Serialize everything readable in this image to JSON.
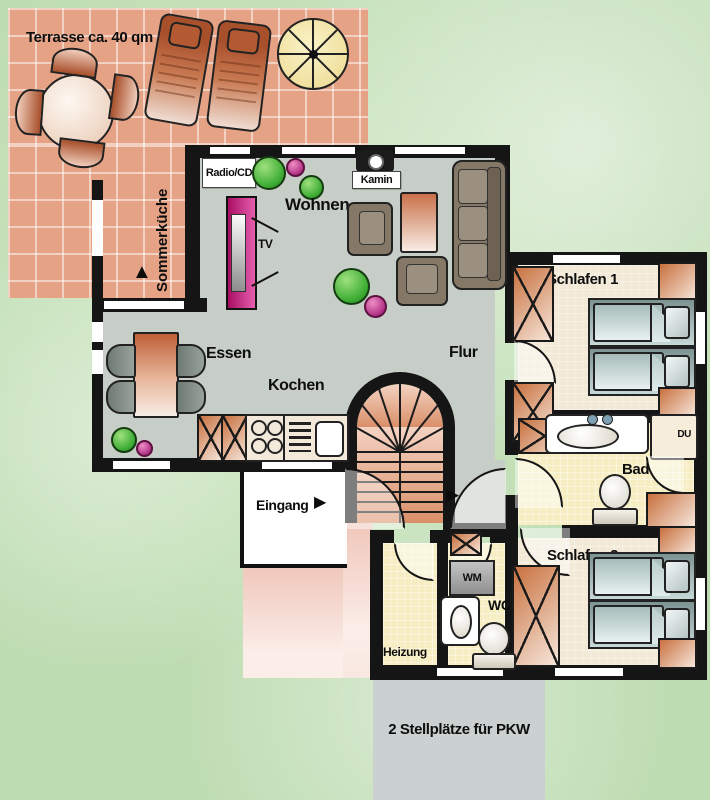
{
  "labels": {
    "terrace": "Terrasse ca. 40 qm",
    "summer_kitchen": "Sommerküche",
    "radio_cd": "Radio/CD",
    "living": "Wohnen",
    "fireplace": "Kamin",
    "tv": "TV",
    "dining": "Essen",
    "kitchen": "Kochen",
    "hall": "Flur",
    "bedroom1": "Schlafen 1",
    "shower": "DU",
    "bath": "Bad",
    "bedroom2": "Schlafen 2",
    "entrance": "Eingang",
    "washing_machine": "WM",
    "wc": "WC",
    "heating": "Heizung",
    "parking": "2 Stellplätze für PKW"
  },
  "icons": {
    "arrow_right": "▶",
    "arrow_up": "▲"
  },
  "colors": {
    "grass": "#bedcb2",
    "tile": "#e5a285",
    "wall": "#151515",
    "floor_main": "#c7cdc7",
    "floor_bed": "#f3e9d7",
    "floor_bath": "#f6eec2",
    "wood": "#c8713f",
    "wood_light": "#f6e6da",
    "magenta": "#c2187c",
    "plant": "#3fae35",
    "furniture": "#857867",
    "bed": "#9fb6b4",
    "parking": "#cbd1d0",
    "path": "#f2cec4",
    "stair_dark": "#d98f69",
    "stair_light": "#f4d3c2"
  }
}
